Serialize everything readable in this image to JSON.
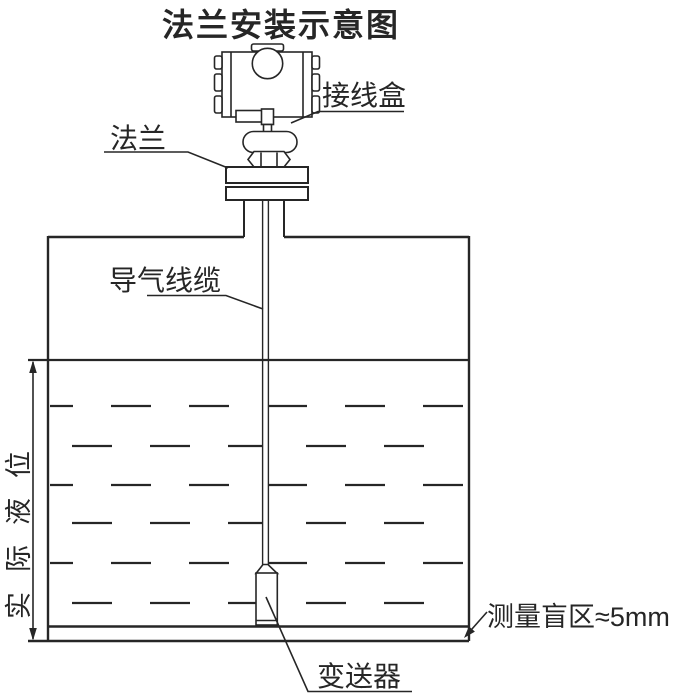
{
  "title": "法兰安装示意图",
  "labels": {
    "junction_box": "接线盒",
    "flange": "法兰",
    "air_guide_cable": "导气线缆",
    "actual_liquid_level": "实际液位",
    "transmitter": "变送器",
    "blind_zone": "测量盲区≈5mm"
  },
  "colors": {
    "line": "#262626",
    "background": "#ffffff"
  }
}
